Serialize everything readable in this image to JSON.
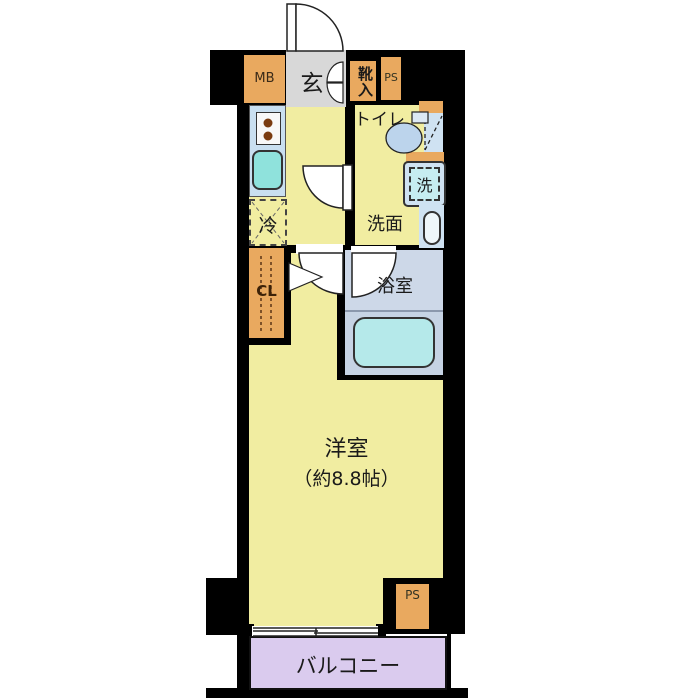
{
  "floorplan": {
    "title": "1K apartment floor plan",
    "labels": {
      "mb": "MB",
      "genkan": "玄",
      "shoe_cabinet": "靴入",
      "ps_top": "PS",
      "toilet": "トイレ",
      "washer": "洗",
      "washroom": "洗面",
      "fridge": "冷",
      "closet": "CL",
      "bathroom": "浴室",
      "main_room": "洋室",
      "main_room_size": "（約8.8帖）",
      "ps_bottom": "PS",
      "balcony": "バルコニー"
    },
    "colors": {
      "wall": "#000000",
      "room_yellow": "#f1eda1",
      "fixture_orange": "#e9a95f",
      "genkan_gray": "#d8d8d8",
      "water_blue": "#cfe2f2",
      "sink_teal": "#8fe2dc",
      "bath_floor": "#cdd8e8",
      "tub_cyan": "#b5e9ea",
      "toilet_blue": "#bcd4ec",
      "balcony_purple": "#dacbee"
    }
  }
}
